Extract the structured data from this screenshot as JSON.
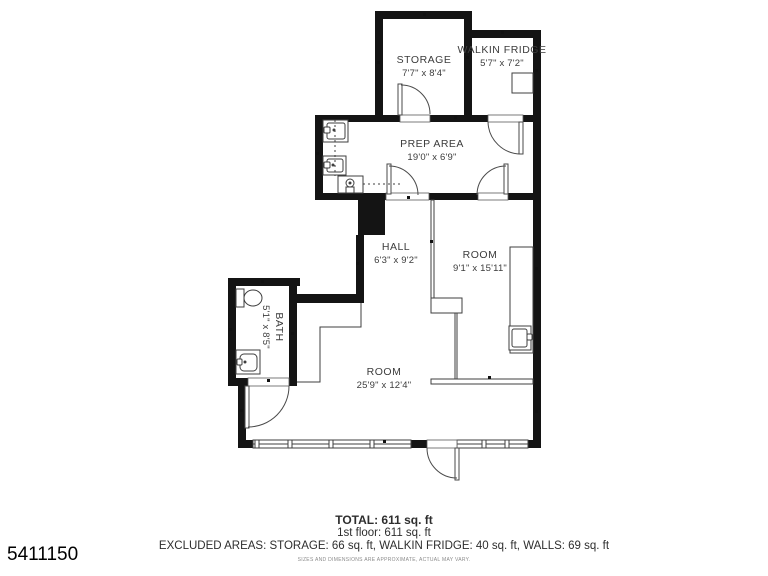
{
  "plan": {
    "rooms": [
      {
        "id": "storage",
        "name": "STORAGE",
        "dims": "7'7\" x 8'4\""
      },
      {
        "id": "walkin-fridge",
        "name": "WALKIN FRIDGE",
        "dims": "5'7\" x 7'2\""
      },
      {
        "id": "prep-area",
        "name": "PREP AREA",
        "dims": "19'0\" x 6'9\""
      },
      {
        "id": "hall",
        "name": "HALL",
        "dims": "6'3\" x 9'2\""
      },
      {
        "id": "room-right",
        "name": "ROOM",
        "dims": "9'1\" x 15'11\""
      },
      {
        "id": "bath",
        "name": "BATH",
        "dims": "5'1\" x 8'5\""
      },
      {
        "id": "room-main",
        "name": "ROOM",
        "dims": "25'9\" x 12'4\""
      }
    ]
  },
  "summary": {
    "total": "TOTAL: 611 sq. ft",
    "floor": "1st floor: 611 sq. ft",
    "excluded": "EXCLUDED AREAS: STORAGE: 66 sq. ft, WALKIN FRIDGE: 40 sq. ft, WALLS: 69 sq. ft",
    "disclaimer": "SIZES AND DIMENSIONS ARE APPROXIMATE, ACTUAL MAY VARY."
  },
  "watermark_id": "5411150",
  "colors": {
    "wall": "#141414",
    "line": "#3f3f3f",
    "text": "#3c3c3c",
    "background": "#ffffff"
  }
}
